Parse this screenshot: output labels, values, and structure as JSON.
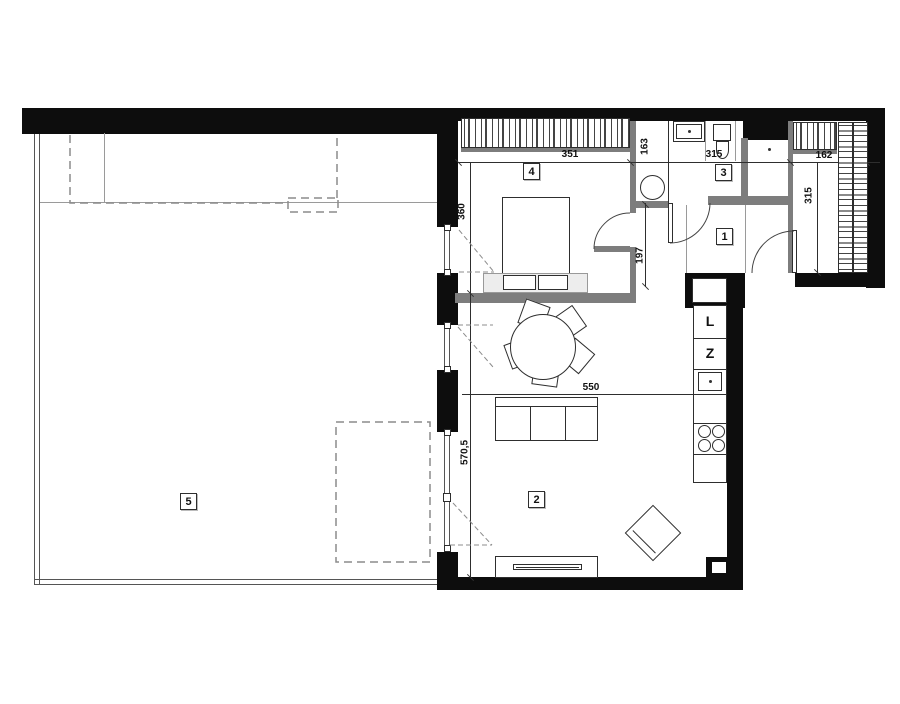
{
  "title": "apartment-floor-plan",
  "colors": {
    "wall": "#0d0d0d",
    "partition": "#7d7d7d",
    "line": "#2e2e2e",
    "dashed": "#8c8c8c"
  },
  "rooms": [
    {
      "number": "1",
      "name": "hall"
    },
    {
      "number": "2",
      "name": "living-room-kitchen"
    },
    {
      "number": "3",
      "name": "bathroom"
    },
    {
      "number": "4",
      "name": "bedroom"
    },
    {
      "number": "5",
      "name": "terrace"
    }
  ],
  "dimensions": {
    "bedroom_width": "351",
    "nook_height": "163",
    "bathroom_width": "315",
    "closet_width": "162",
    "bedroom_depth": "360",
    "hall_depth": "197",
    "closet_depth": "315",
    "living_width": "550",
    "living_depth": "570,5"
  },
  "appliances": {
    "fridge": "L",
    "dishwasher": "Z"
  }
}
